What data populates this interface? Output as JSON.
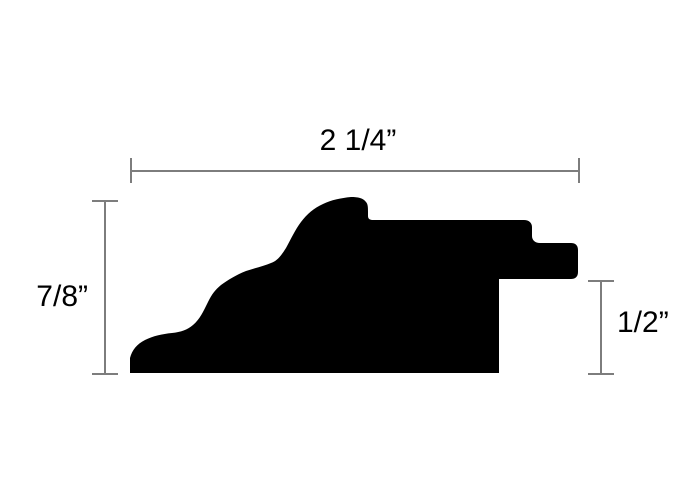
{
  "dimensions": {
    "top": {
      "label": "2 1/4”"
    },
    "left": {
      "label": "7/8”"
    },
    "right": {
      "label": "1/2”"
    }
  },
  "colors": {
    "profile_fill": "#000000",
    "dimension_line": "#7d7d7d",
    "label_text": "#000000",
    "background": "#ffffff"
  },
  "profile": {
    "path": "M 130 373 L 130 358 C 132 350 137 344 145 340 C 153 336 162 334 172 333 C 181 332 187 330 193 325 C 200 319 203 312 208 302 C 212 294 215 290 221 285 C 228 280 236 275 246 271 C 255 268 264 266 271 263 C 277 261 281 256 286 248 C 291 239 295 230 301 222 C 307 214 314 208 323 204 C 331 200 341 198 351 197 C 358 197 363 198 366 202 C 368 204 368 208 368 212 L 368 216 C 368 219 370 220 373 220 L 524 220 C 529 220 532 223 532 227 L 532 236 C 532 240 535 243 540 243 L 571 243 C 575 243 578 245 578 250 L 578 272 C 578 277 575 279 571 279 L 499 279 L 499 373 Z"
  }
}
